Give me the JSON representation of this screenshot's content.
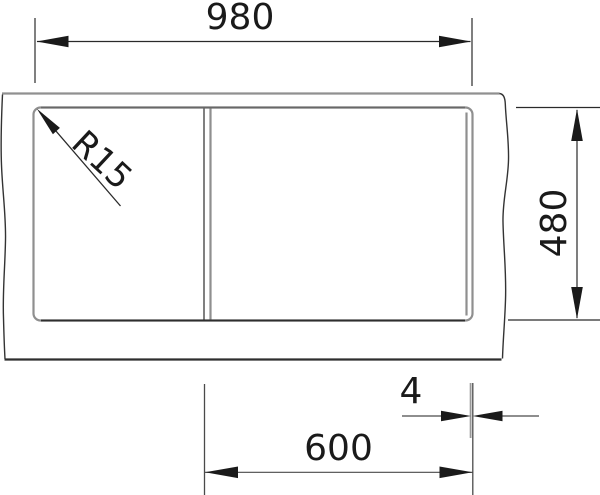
{
  "drawing": {
    "title": "Sink technical dimension drawing (top view)",
    "dimensions": {
      "overall_width": "980",
      "overall_depth": "480",
      "bowl_width": "600",
      "rim_offset": "4",
      "corner_radius": "R15"
    },
    "colors": {
      "background": "#ffffff",
      "dimension_ink": "#1a1a1a",
      "outline_gray": "#8f8f8f",
      "outline_mid_gray": "#666666",
      "outline_dark": "#2e2e2e"
    }
  }
}
